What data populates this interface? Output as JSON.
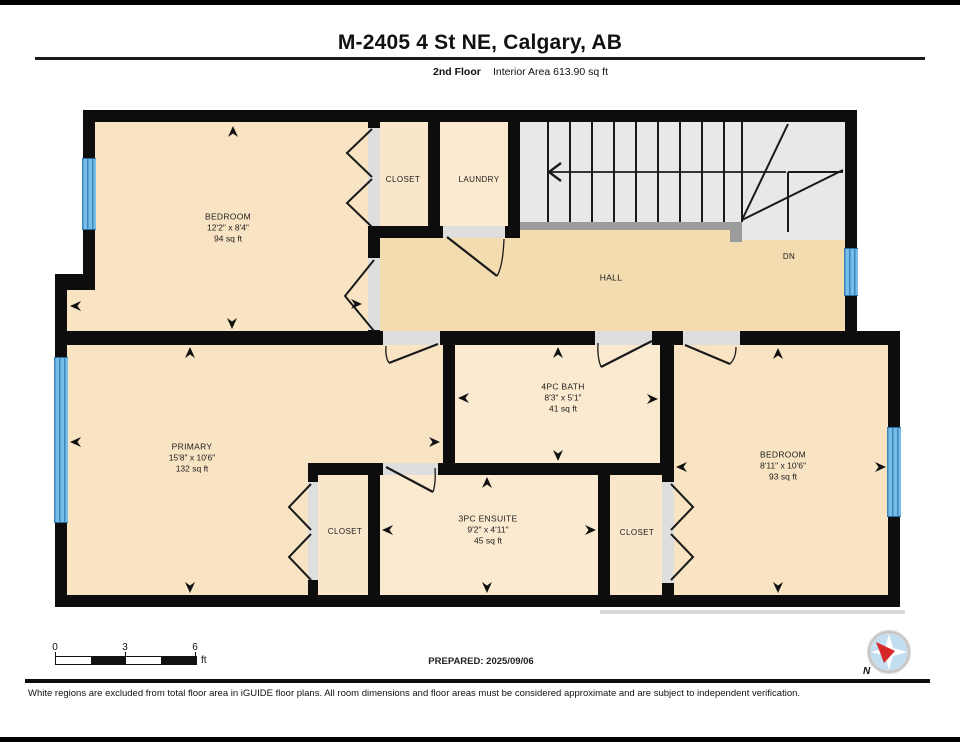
{
  "header": {
    "title": "M-2405 4 St NE, Calgary, AB",
    "floor_label": "2nd Floor",
    "area_label": "Interior Area 613.90 sq ft"
  },
  "rooms": {
    "bedroom_tl": {
      "name": "BEDROOM",
      "dims": "12'2\" x 8'4\"",
      "area": "94 sq ft"
    },
    "closet_top": {
      "name": "CLOSET"
    },
    "laundry": {
      "name": "LAUNDRY"
    },
    "hall": {
      "name": "HALL"
    },
    "stairs": {
      "direction_label": "DN"
    },
    "primary": {
      "name": "PRIMARY",
      "dims": "15'8\" x 10'6\"",
      "area": "132 sq ft"
    },
    "bath": {
      "name": "4PC BATH",
      "dims": "8'3\" x 5'1\"",
      "area": "41 sq ft"
    },
    "ensuite": {
      "name": "3PC ENSUITE",
      "dims": "9'2\" x 4'11\"",
      "area": "45 sq ft"
    },
    "closet_primary": {
      "name": "CLOSET"
    },
    "closet_right": {
      "name": "CLOSET"
    },
    "bedroom_right": {
      "name": "BEDROOM",
      "dims": "8'11\" x 10'6\"",
      "area": "93 sq ft"
    }
  },
  "scale_bar": {
    "labels": [
      "0",
      "3",
      "6"
    ],
    "unit": "ft"
  },
  "footer": {
    "prepared": "PREPARED: 2025/09/06",
    "disclaimer": "White regions are excluded from total floor area in iGUIDE floor plans. All room dimensions and floor areas must be considered approximate and are subject to independent verification."
  },
  "compass": {
    "north_label": "N"
  },
  "colors": {
    "wall": "#0d0d0d",
    "room_fill": "#F8E3C3",
    "wet_room_fill": "#FBEAD0",
    "closet_fill": "#FAE6CA",
    "hall_fill": "#F2DCB0",
    "stair_fill": "#E8E8E8",
    "stair_edge": "#9B9B9B",
    "window_blue": "#74BEE9",
    "threshold": "#DEDEDE"
  }
}
